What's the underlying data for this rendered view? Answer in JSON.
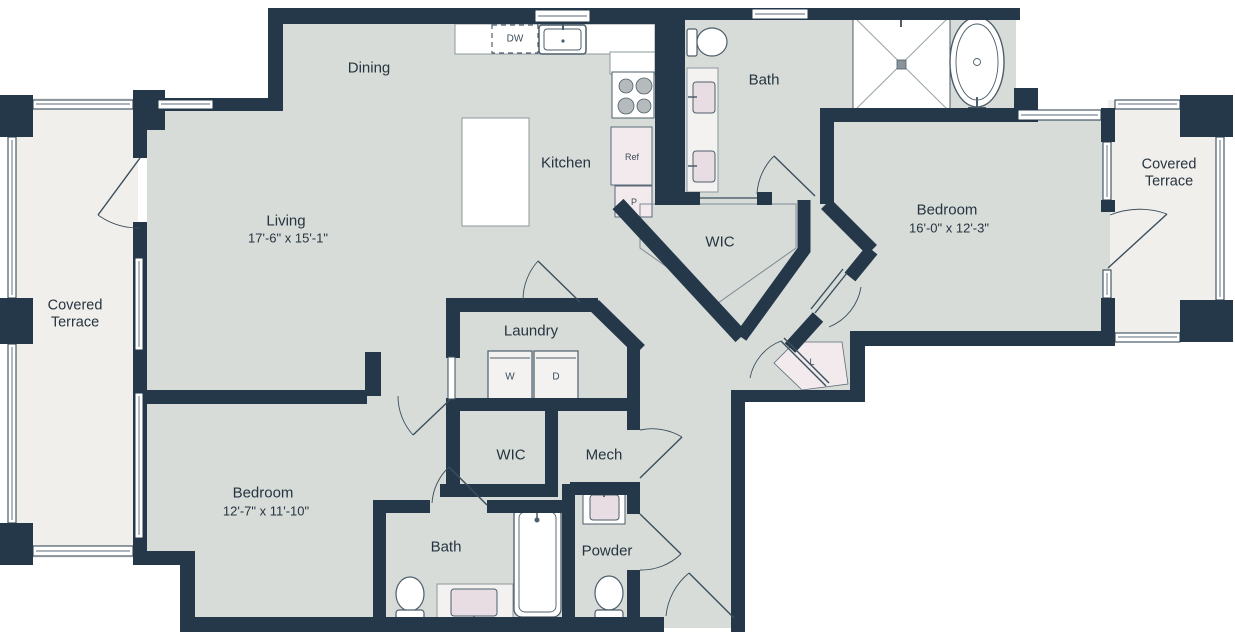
{
  "colors": {
    "wall": "#24384a",
    "floor": "#d7dcd9",
    "terrace_floor": "#f1efec",
    "fixture_fill": "#ffffff",
    "accent_pink": "#f3eaee",
    "text": "#26343f"
  },
  "rooms": {
    "dining": {
      "name": "Dining"
    },
    "living": {
      "name": "Living",
      "dims": "17'-6\" x 15'-1\""
    },
    "kitchen": {
      "name": "Kitchen"
    },
    "bath_main": {
      "name": "Bath"
    },
    "wic_main": {
      "name": "WIC"
    },
    "bedroom_main": {
      "name": "Bedroom",
      "dims": "16'-0\" x 12'-3\""
    },
    "terrace_left": {
      "name": "Covered\nTerrace"
    },
    "terrace_right": {
      "name": "Covered\nTerrace"
    },
    "laundry": {
      "name": "Laundry"
    },
    "wic_second": {
      "name": "WIC"
    },
    "mech": {
      "name": "Mech"
    },
    "bedroom_second": {
      "name": "Bedroom",
      "dims": "12'-7\" x 11'-10\""
    },
    "bath_second": {
      "name": "Bath"
    },
    "powder": {
      "name": "Powder"
    }
  },
  "fixtures": {
    "dishwasher": "DW",
    "refrigerator": "Ref",
    "pantry": "P",
    "washer": "W",
    "dryer": "D",
    "linen": "L"
  }
}
